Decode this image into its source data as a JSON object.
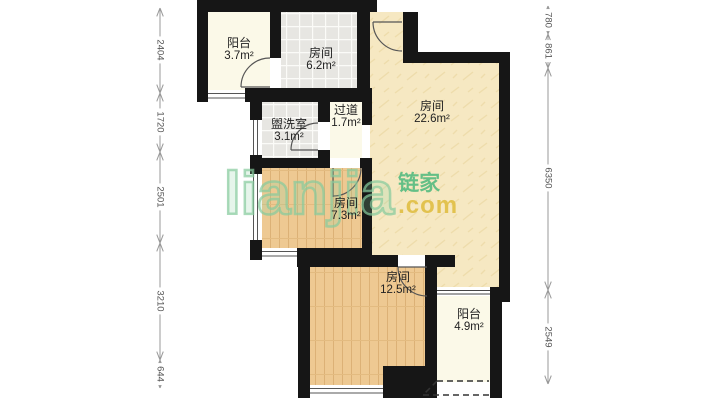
{
  "plan": {
    "rooms": [
      {
        "id": "balcony-top",
        "name": "阳台",
        "area": "3.7m²"
      },
      {
        "id": "room-6-2",
        "name": "房间",
        "area": "6.2m²"
      },
      {
        "id": "washroom",
        "name": "盥洗室",
        "area": "3.1m²"
      },
      {
        "id": "hallway",
        "name": "过道",
        "area": "1.7m²"
      },
      {
        "id": "room-22-6",
        "name": "房间",
        "area": "22.6m²"
      },
      {
        "id": "room-7-3",
        "name": "房间",
        "area": "7.3m²"
      },
      {
        "id": "room-12-5",
        "name": "房间",
        "area": "12.5m²"
      },
      {
        "id": "balcony-bottom",
        "name": "阳台",
        "area": "4.9m²"
      }
    ],
    "dimensions": {
      "left": [
        "2404",
        "1720",
        "2501",
        "3210",
        "644"
      ],
      "right": [
        "780",
        "861",
        "6350",
        "2549"
      ]
    }
  },
  "watermark": {
    "brand": "lianjia",
    "brand_cn": "链家",
    "domain": ".com"
  },
  "colors": {
    "wall": "#161616",
    "wood_floor": "#eec992",
    "tile_floor": "#e7e6e2",
    "textured_floor": "#f6e8c2",
    "plain_floor": "#fbf9e8",
    "watermark_green": "#86ca9c",
    "watermark_gold": "#e2c24f",
    "dimension_line": "#999999"
  }
}
